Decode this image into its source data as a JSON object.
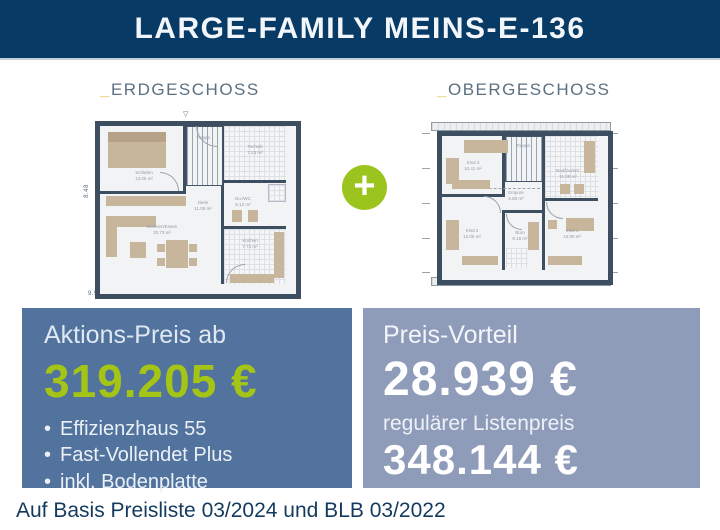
{
  "header": {
    "title": "LARGE-FAMILY MEINS-E-136"
  },
  "plans": {
    "plus_symbol": "+",
    "erdgeschoss": {
      "label_prefix": "_",
      "label": "ERDGESCHOSS",
      "width_dimension": "9.58",
      "height_dimension": "8.48",
      "marker_icon": "▽",
      "rooms": [
        {
          "name": "Schlafen",
          "area": "13.05 m²"
        },
        {
          "name": "Treppe",
          "area": ""
        },
        {
          "name": "Technik",
          "area": "7.23 m²"
        },
        {
          "name": "Diele",
          "area": "11.05 m²"
        },
        {
          "name": "Du./WC",
          "area": "5.12 m²"
        },
        {
          "name": "Wohnen/Essen",
          "area": "30.73 m²"
        },
        {
          "name": "Kochen",
          "area": "7.73 m²"
        }
      ]
    },
    "obergeschoss": {
      "label_prefix": "_",
      "label": "OBERGESCHOSS",
      "rooms": [
        {
          "name": "Kind 3",
          "area": "10.41 m²"
        },
        {
          "name": "Treppe",
          "area": ""
        },
        {
          "name": "Bad/Du/WC",
          "area": "11.08 m²"
        },
        {
          "name": "Empore",
          "area": "6.89 m²"
        },
        {
          "name": "Kind 2",
          "area": "12.05 m²"
        },
        {
          "name": "Büro",
          "area": "8.16 m²"
        },
        {
          "name": "Kind 1",
          "area": "13.80 m²"
        }
      ]
    }
  },
  "pricing": {
    "action": {
      "label": "Aktions-Preis ab",
      "price": "319.205 €",
      "bullet": "•",
      "bullets": [
        "Effizienzhaus 55",
        "Fast-Vollendet Plus",
        "inkl. Bodenplatte"
      ]
    },
    "advantage": {
      "label": "Preis-Vorteil",
      "price": "28.939 €",
      "sublabel": "regulärer Listenpreis",
      "list_price": "348.144 €"
    }
  },
  "footnote": "Auf Basis Preisliste 03/2024 und BLB 03/2022",
  "colors": {
    "header_bg": "#073b66",
    "accent_green": "#9cc41e",
    "price_green": "#a4c515",
    "box_dark_blue": "#52739d",
    "box_light_blue": "#8e9cba",
    "label_gold": "#e7bd3f",
    "label_slate": "#5c7080",
    "footnote_navy": "#143a5f",
    "plan_wall": "#3d4e61",
    "furniture_beige": "#c8b69c"
  }
}
